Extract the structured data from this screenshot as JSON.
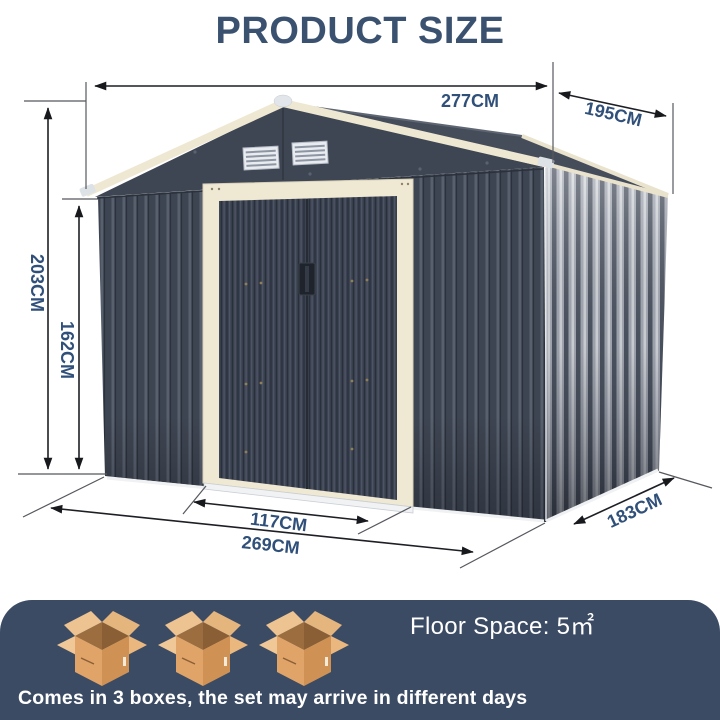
{
  "title": "PRODUCT SIZE",
  "dims": {
    "roof_width": "277CM",
    "roof_depth": "195CM",
    "overall_height": "203CM",
    "wall_height": "162CM",
    "door_width": "117CM",
    "base_width": "269CM",
    "base_depth": "183CM"
  },
  "footer": {
    "floor_space": "Floor Space: 5㎡",
    "note": "Comes in 3 boxes, the set may arrive in different days",
    "box_count": "3"
  },
  "colors": {
    "title_text": "#3a526f",
    "dim_text": "#30507a",
    "banner_bg": "#3c4b64",
    "shed_dark": "#3f4653",
    "trim_cream": "#efe8d3",
    "box_tan": "#e0a469"
  }
}
